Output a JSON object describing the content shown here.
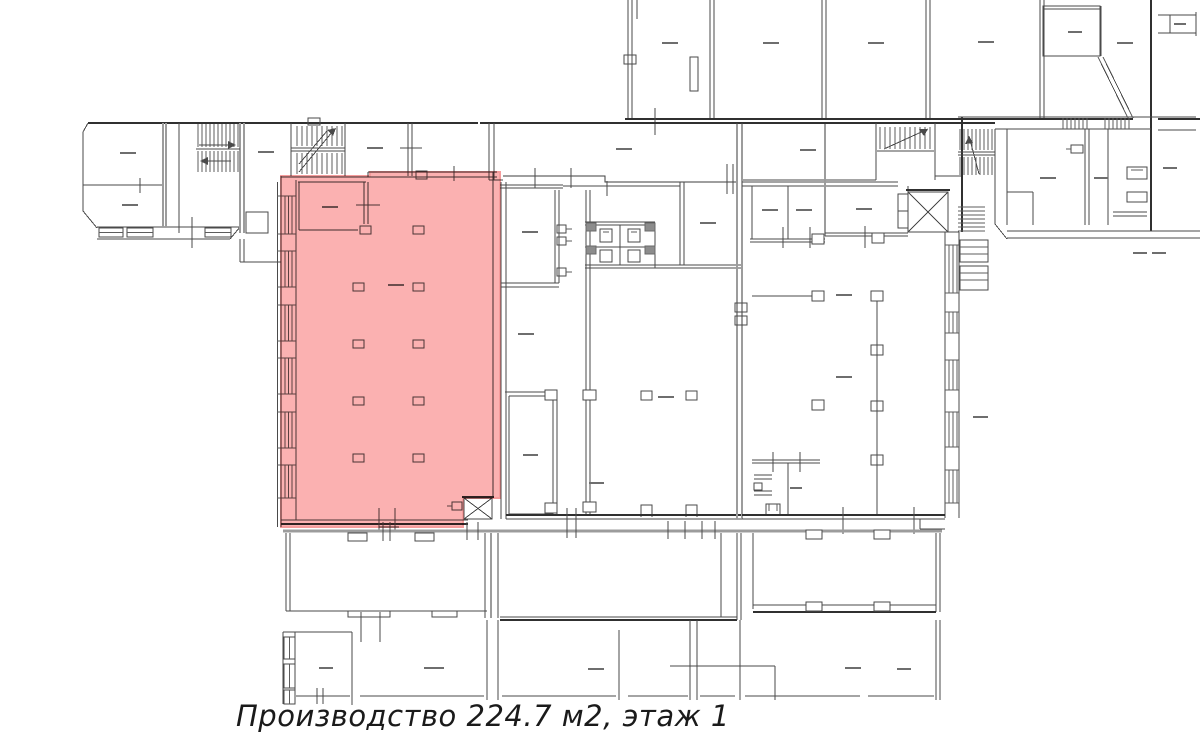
{
  "plan": {
    "type": "floor-plan",
    "caption": "Производство 224.7 м2, этаж 1",
    "highlight": {
      "label": "Производство",
      "area": "224.7 м2",
      "floor": "этаж 1",
      "fill": "#fbb1b1",
      "border": "#f59c9c"
    },
    "line_color": "#4a4a4a",
    "background": "#ffffff"
  }
}
